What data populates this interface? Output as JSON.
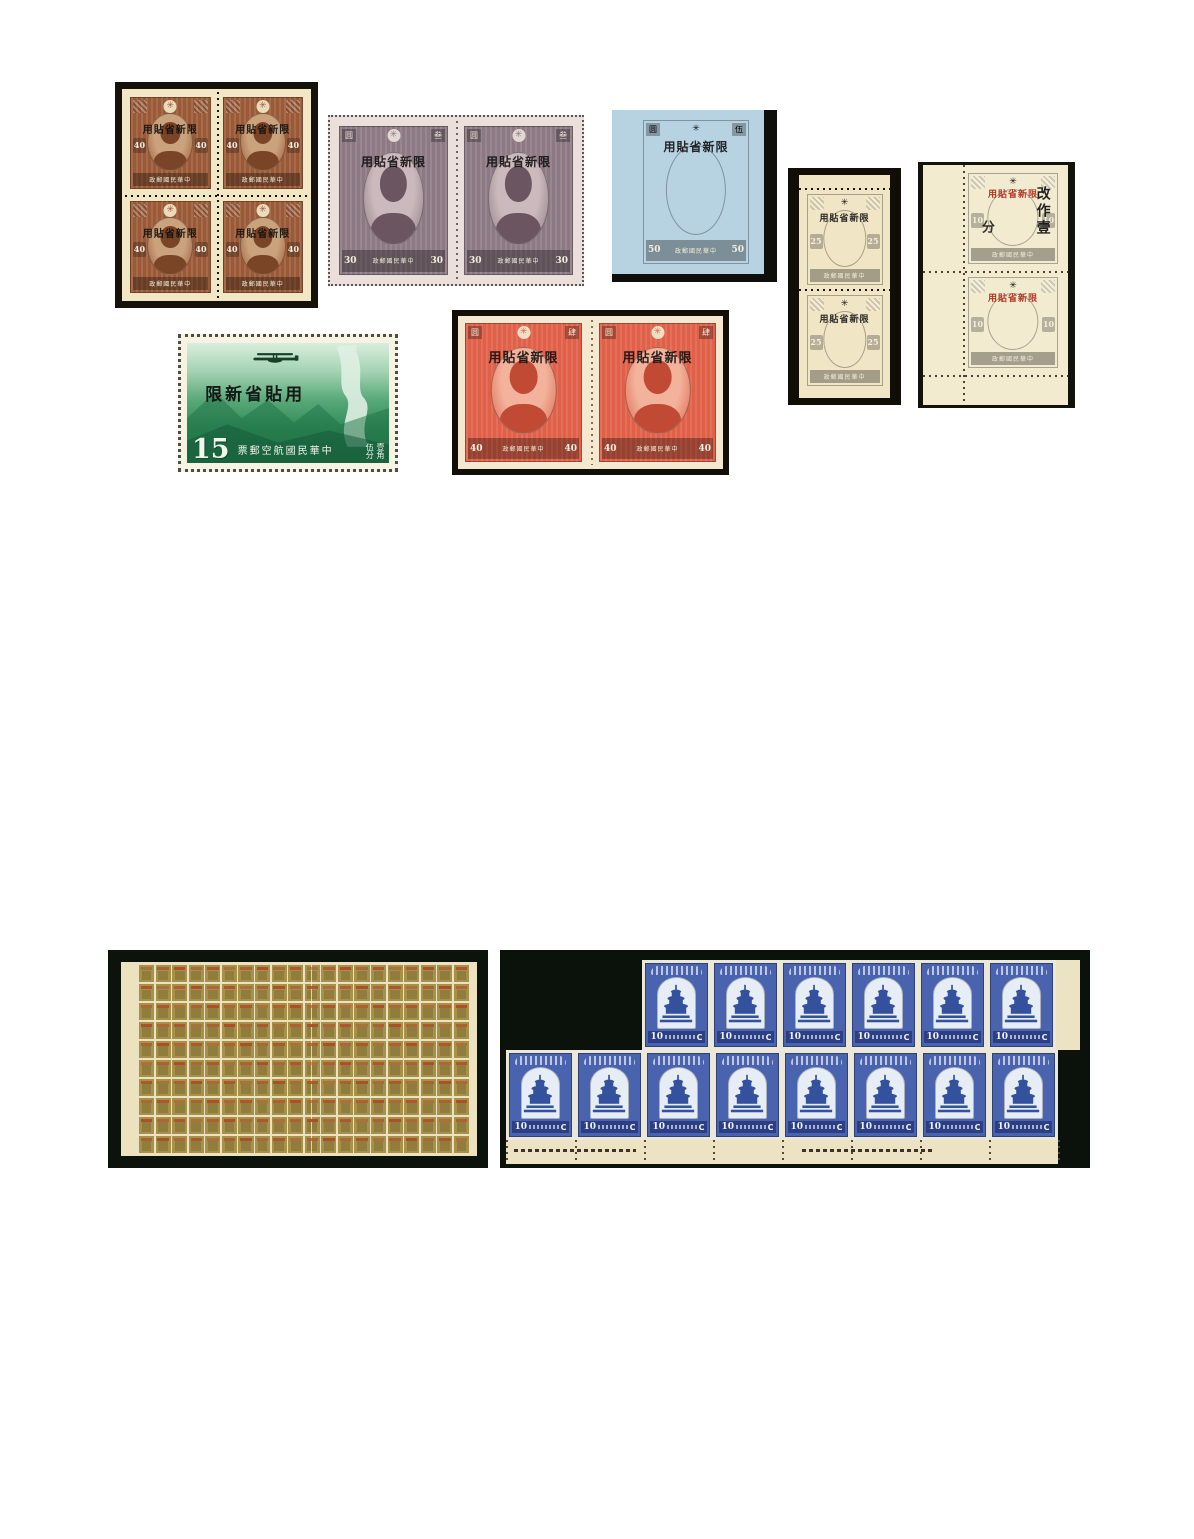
{
  "page": {
    "background": "#ffffff"
  },
  "lots": {
    "brown_block": {
      "overprint": "用貼省新限",
      "denomination": "40",
      "inscription": "政郵國民華中",
      "rows": 2,
      "cols": 2,
      "colors": {
        "backing": "#16120b",
        "paper": "#f1e7c5",
        "ink": "#9b5a37",
        "panel": "#caa27c",
        "portrait": "#7a4426"
      }
    },
    "purple_pair": {
      "overprint": "用貼省新限",
      "denomination": "30",
      "inscription": "政郵國民華中",
      "corner_left": "圆",
      "corner_right": "叁",
      "count": 2,
      "colors": {
        "paper": "#eadfdb",
        "ink": "#8d7983",
        "panel": "#cbb9bd",
        "portrait": "#6a5560"
      }
    },
    "blue_single": {
      "overprint": "用貼省新限",
      "denomination": "50",
      "inscription": "政郵國民華中",
      "corner_left": "圆",
      "corner_right": "伍",
      "colors": {
        "backing": "#0e0e0c",
        "paper": "#b7d3e2",
        "ink": "#46 6fb5",
        "ink_fix": "#466fb5",
        "panel": "#a9c7e0",
        "portrait": "#30518f"
      }
    },
    "brown_pair": {
      "overprint": "用貼省新限",
      "denomination": "25",
      "inscription": "政郵國民華中",
      "count": 2,
      "colors": {
        "backing": "#110e08",
        "paper": "#f0e6c6",
        "ink": "#6a5340",
        "panel": "#a98f72",
        "portrait": "#4b3827"
      }
    },
    "green_pair": {
      "overprint": "用貼省新限",
      "overprint_color": "#b33b28",
      "surcharge_main": "改作壹",
      "surcharge_tail": "分",
      "denomination": "10",
      "inscription": "政郵國民華中",
      "count": 2,
      "colors": {
        "backing": "#12140c",
        "paper": "#f2ebd0",
        "ink": "#43a16b",
        "panel": "#bfe0c9",
        "portrait": "#2f7b4f"
      }
    },
    "airmail": {
      "overprint": "限新省貼用",
      "denomination": "15",
      "inscription": "票郵空航國民華中",
      "value_right_top": "壹角",
      "value_right_bottom": "伍分",
      "colors": {
        "paper": "#f7f3e3",
        "ink": "#2f8a56",
        "sky": "#d9eedd",
        "wall": "#dff0e2"
      }
    },
    "red_pair": {
      "overprint": "用貼省新限",
      "denomination": "40",
      "inscription": "政郵國民華中",
      "corner_left": "圆",
      "corner_right": "肆",
      "count": 2,
      "colors": {
        "backing": "#120f08",
        "paper": "#f4e9d0",
        "ink": "#e06048",
        "panel": "#f2b29b",
        "portrait": "#c04a34"
      }
    },
    "olive_sheet": {
      "rows": 10,
      "cols": 20,
      "colors": {
        "backing": "#0c130c",
        "selvage": "#ece2bf",
        "stamp": "#a6914a",
        "inner": "#907d3e",
        "band": "#b04c26"
      }
    },
    "blue_block": {
      "denomination": "10",
      "currency_letter": "C",
      "top_row_count": 6,
      "bottom_row_count": 8,
      "colors": {
        "backing": "#0b120b",
        "stamp_ink": "#4a63ae",
        "window": "#e7edf5",
        "temple": "#34519e",
        "band": "#2c3f84",
        "selvage": "#ebe3c4"
      }
    }
  }
}
